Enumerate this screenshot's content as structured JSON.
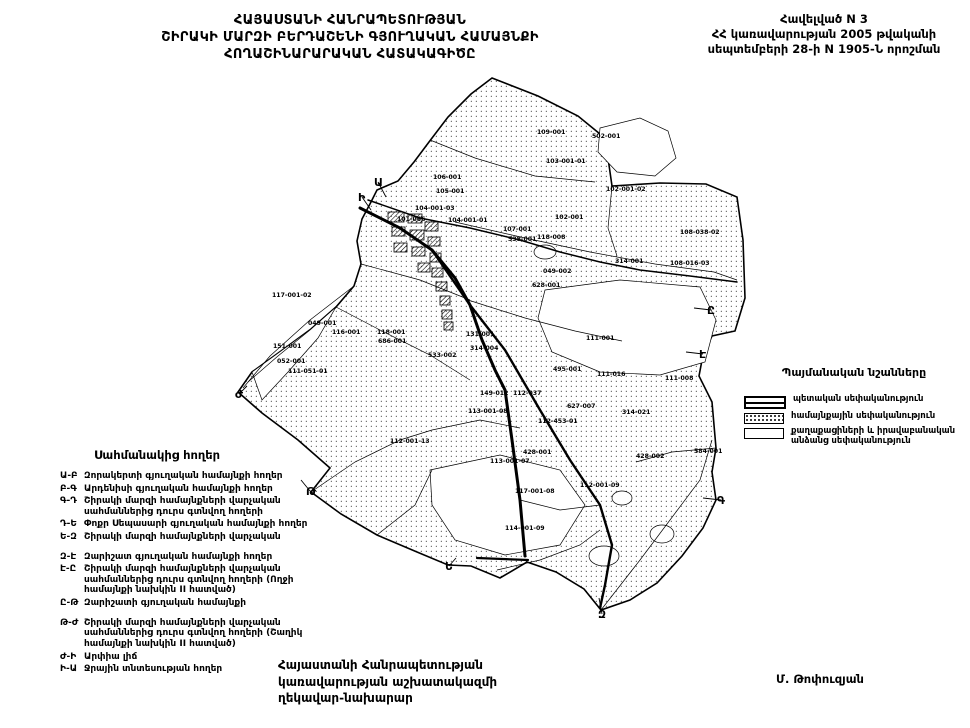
{
  "header": {
    "title_lines": [
      "ՀԱՅԱՍՏԱՆԻ ՀԱՆՐԱՊԵՏՈՒԹՅԱՆ",
      "ՇԻՐԱԿԻ ՄԱՐԶԻ ԲԵՐԴԱՇԵՆԻ ԳՅՈՒՂԱԿԱՆ ՀԱՄԱՅՆՔԻ",
      "ՀՈՂԱՇԻՆԱՐԱՐԱԿԱՆ ՀԱՏԱԿԱԳԻԾԸ"
    ],
    "annex_lines": [
      "Հավելված N 3",
      "ՀՀ կառավարության 2005 թվականի",
      "սեպտեմբերի 28-ի N 1905-Ն որոշման"
    ]
  },
  "legend": {
    "title": "Պայմանական նշանները",
    "items": [
      {
        "swatch": "state",
        "label": "պետական սեփականություն"
      },
      {
        "swatch": "community",
        "label": "համայնքային սեփականություն"
      },
      {
        "swatch": "private",
        "label": "քաղաքացիների և իրավաբանական անձանց սեփականություն"
      }
    ]
  },
  "border_lands": {
    "title": "Սահմանակից հողեր",
    "items": [
      {
        "code": "Ա-Բ",
        "text": "Զորակերտի գյուղական համայնքի հողեր",
        "gap": false
      },
      {
        "code": "Բ-Գ",
        "text": "Արդենիսի գյուղական համայնքի հողեր",
        "gap": false
      },
      {
        "code": "Գ-Դ",
        "text": "Շիրակի մարզի համայնքների վարչական սահմաններից դուրս գտնվող հողերի",
        "gap": false
      },
      {
        "code": "Դ-Ե",
        "text": "Փոքր Սեպասարի գյուղական համայնքի հողեր",
        "gap": false
      },
      {
        "code": "Ե-Զ",
        "text": "Շիրակի մարզի համայնքների վարչական",
        "gap": false
      },
      {
        "code": "Զ-Է",
        "text": "Զարիշատ գյուղական համայնքի հողեր",
        "gap": true
      },
      {
        "code": "Է-Ը",
        "text": "Շիրակի մարզի համայնքների վարչական սահմաններից դուրս գտնվող հողերի (Ողջի համայնքի նախկին II հատված)",
        "gap": false
      },
      {
        "code": "Ը-Թ",
        "text": "Զարիշատի գյուղական համայնքի",
        "gap": false
      },
      {
        "code": "Թ-Ժ",
        "text": "Շիրակի մարզի համայնքների վարչական սահմաններից դուրս գտնվող հողերի (Շաղիկ համայնքի նախկին II հատված)",
        "gap": true
      },
      {
        "code": "Ժ-Ի",
        "text": "Արփիա լիճ",
        "gap": false
      },
      {
        "code": "Ի-Ա",
        "text": "Ջրային տնտեսության հողեր",
        "gap": false
      }
    ]
  },
  "footer": {
    "left_lines": [
      "Հայաստանի Հանրապետության",
      "կառավարության աշխատակազմի",
      "ղեկավար-նախարար"
    ],
    "signature": "Մ. Թոփուզյան"
  },
  "map": {
    "parcel_labels": [
      {
        "t": "109-001",
        "x": 537,
        "y": 134
      },
      {
        "t": "502-001",
        "x": 592,
        "y": 138
      },
      {
        "t": "103-001-01",
        "x": 546,
        "y": 163
      },
      {
        "t": "106-001",
        "x": 433,
        "y": 179
      },
      {
        "t": "105-001",
        "x": 436,
        "y": 193
      },
      {
        "t": "102-001-02",
        "x": 606,
        "y": 191
      },
      {
        "t": "104-001-03",
        "x": 415,
        "y": 210
      },
      {
        "t": "101-066",
        "x": 397,
        "y": 221
      },
      {
        "t": "104-001-01",
        "x": 448,
        "y": 222
      },
      {
        "t": "102-001",
        "x": 555,
        "y": 219
      },
      {
        "t": "107-001",
        "x": 503,
        "y": 231
      },
      {
        "t": "538-001",
        "x": 508,
        "y": 241
      },
      {
        "t": "118-008",
        "x": 537,
        "y": 239
      },
      {
        "t": "108-038-02",
        "x": 680,
        "y": 234
      },
      {
        "t": "314-001",
        "x": 615,
        "y": 263
      },
      {
        "t": "108-016-03",
        "x": 670,
        "y": 265
      },
      {
        "t": "628-001",
        "x": 532,
        "y": 287
      },
      {
        "t": "049-002",
        "x": 543,
        "y": 273
      },
      {
        "t": "117-001-02",
        "x": 272,
        "y": 297
      },
      {
        "t": "049-001",
        "x": 308,
        "y": 325
      },
      {
        "t": "116-001",
        "x": 332,
        "y": 334
      },
      {
        "t": "118-001",
        "x": 377,
        "y": 334
      },
      {
        "t": "686-001",
        "x": 378,
        "y": 343
      },
      {
        "t": "151-001",
        "x": 273,
        "y": 348
      },
      {
        "t": "052-001",
        "x": 277,
        "y": 363
      },
      {
        "t": "111-051-01",
        "x": 288,
        "y": 373
      },
      {
        "t": "533-002",
        "x": 428,
        "y": 357
      },
      {
        "t": "131-001",
        "x": 466,
        "y": 336
      },
      {
        "t": "314-004",
        "x": 470,
        "y": 350
      },
      {
        "t": "111-001",
        "x": 586,
        "y": 340
      },
      {
        "t": "495-001",
        "x": 553,
        "y": 371
      },
      {
        "t": "111-016",
        "x": 597,
        "y": 376
      },
      {
        "t": "111-008",
        "x": 665,
        "y": 380
      },
      {
        "t": "112-037",
        "x": 513,
        "y": 395
      },
      {
        "t": "149-012",
        "x": 480,
        "y": 395
      },
      {
        "t": "627-007",
        "x": 567,
        "y": 408
      },
      {
        "t": "314-021",
        "x": 622,
        "y": 414
      },
      {
        "t": "113-001-08",
        "x": 468,
        "y": 413
      },
      {
        "t": "112-453-01",
        "x": 538,
        "y": 423
      },
      {
        "t": "112-001-13",
        "x": 390,
        "y": 443
      },
      {
        "t": "428-001",
        "x": 523,
        "y": 454
      },
      {
        "t": "428-002",
        "x": 636,
        "y": 458
      },
      {
        "t": "584-001",
        "x": 694,
        "y": 453
      },
      {
        "t": "113-001-07",
        "x": 490,
        "y": 463
      },
      {
        "t": "112-001-09",
        "x": 580,
        "y": 487
      },
      {
        "t": "117-001-08",
        "x": 515,
        "y": 493
      },
      {
        "t": "114-001-09",
        "x": 505,
        "y": 530
      }
    ],
    "boundary_letters": [
      {
        "ch": "Ա",
        "x": 374,
        "y": 186,
        "tx": 386,
        "ty": 197
      },
      {
        "ch": "Ի",
        "x": 358,
        "y": 201,
        "tx": 371,
        "ty": 210
      },
      {
        "ch": "Ը",
        "x": 707,
        "y": 314,
        "tx": 694,
        "ty": 308
      },
      {
        "ch": "Է",
        "x": 699,
        "y": 358,
        "tx": 686,
        "ty": 352
      },
      {
        "ch": "Գ",
        "x": 717,
        "y": 504,
        "tx": 703,
        "ty": 498
      },
      {
        "ch": "Ե",
        "x": 445,
        "y": 570,
        "tx": 456,
        "ty": 558
      },
      {
        "ch": "Զ",
        "x": 598,
        "y": 618,
        "tx": 599,
        "ty": 598
      },
      {
        "ch": "Թ",
        "x": 306,
        "y": 495,
        "tx": 301,
        "ty": 480
      },
      {
        "ch": "Ժ",
        "x": 235,
        "y": 398,
        "tx": 247,
        "ty": 386
      }
    ]
  }
}
